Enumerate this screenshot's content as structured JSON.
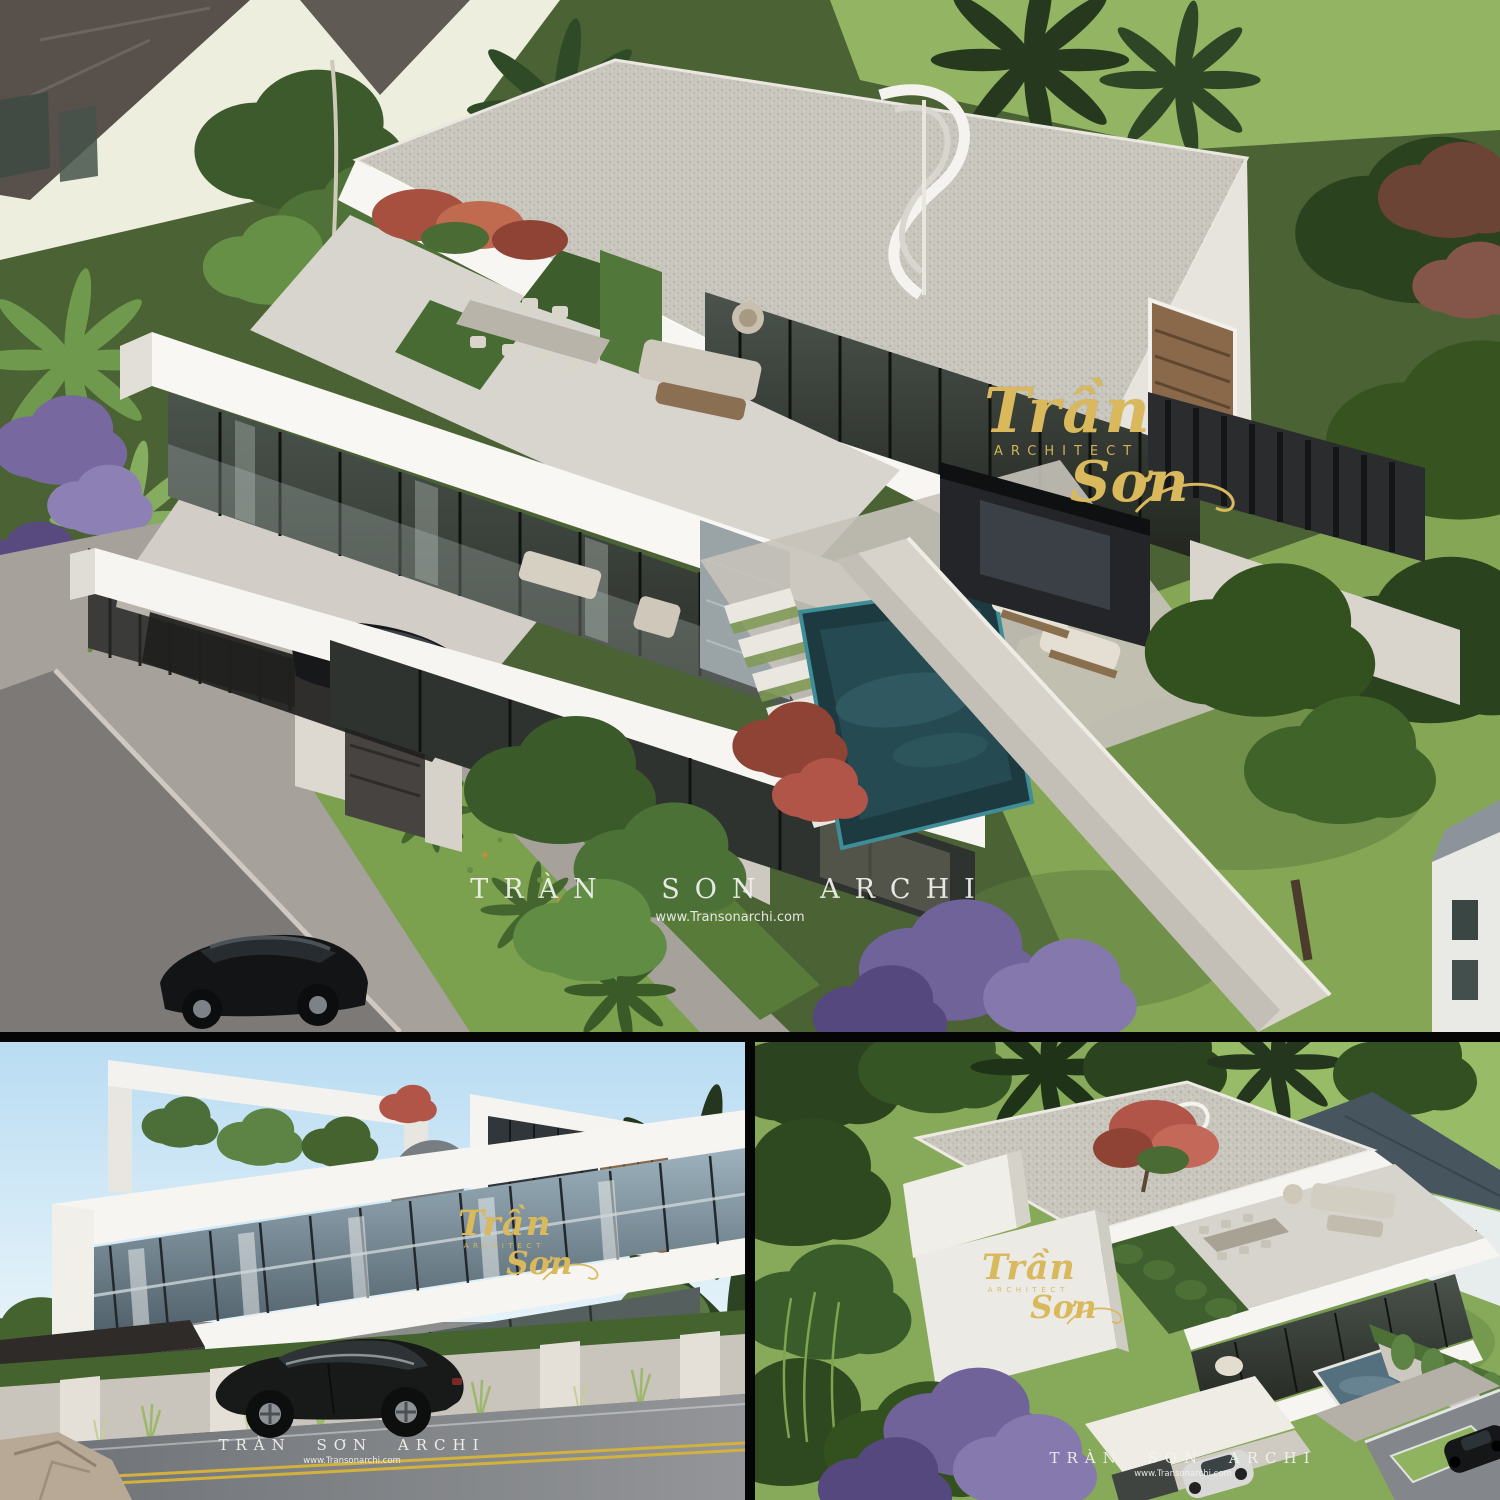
{
  "brand": {
    "logo_script_top": "Trần",
    "logo_subtitle": "ARCHITECT",
    "logo_script_bottom": "Sơn",
    "gold_color": "#d9b95c"
  },
  "watermarks": {
    "aerial": {
      "line1": "TRÀN SON ARCHI",
      "line2": "www.Transonarchi.com"
    },
    "street": {
      "line1": "TRÀN SƠN ARCHI",
      "line2": "www.Transonarchi.com"
    },
    "rear": {
      "line1": "TRÀN SON ARCHI",
      "line2": "www.Transonarchi.com"
    }
  },
  "palette": {
    "white_slab": "#f6f5f1",
    "speckled_roof": "#c9c6bd",
    "glass_dark": "#2d322e",
    "pool_water": "#1d3a40",
    "lawn_green": "#85a755",
    "sky_blue": "#bfe0f2",
    "asphalt": "#7d7976"
  }
}
